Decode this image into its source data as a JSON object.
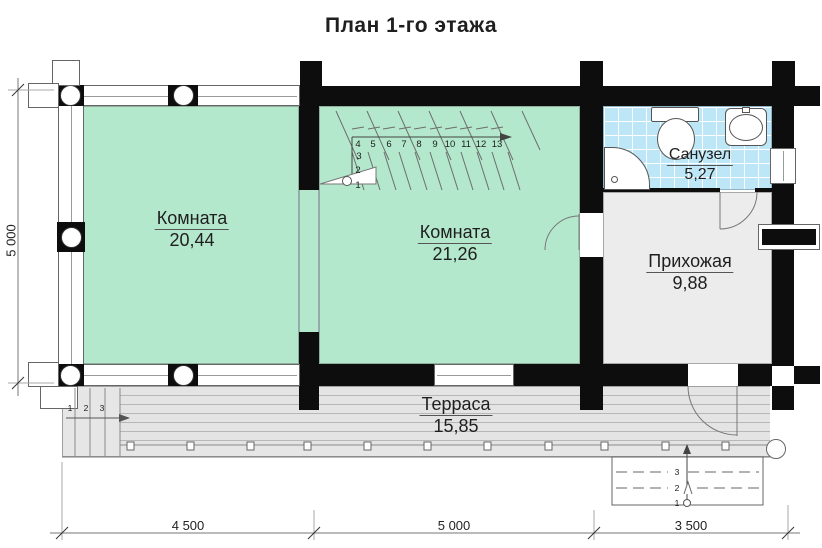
{
  "title": "План 1-го этажа",
  "rooms": {
    "room1": {
      "name": "Комната",
      "area": "20,44"
    },
    "room2": {
      "name": "Комната",
      "area": "21,26"
    },
    "bathroom": {
      "name": "Санузел",
      "area": "5,27"
    },
    "hallway": {
      "name": "Прихожая",
      "area": "9,88"
    },
    "terrace": {
      "name": "Терраса",
      "area": "15,85"
    }
  },
  "dimensions": {
    "left_height": "5 000",
    "bottom": [
      "4 500",
      "5 000",
      "3 500"
    ]
  },
  "stairs": {
    "main_treads": [
      "4",
      "5",
      "6",
      "7",
      "8",
      "9",
      "10",
      "11",
      "12",
      "13"
    ],
    "lower_treads": [
      "3",
      "2",
      "1"
    ],
    "terrace_side_steps": [
      "1",
      "2",
      "3"
    ],
    "entrance_steps": [
      "3",
      "2",
      "1"
    ]
  },
  "colors": {
    "wall": "#0d0d0d",
    "green": "#b4e8cc",
    "tile": "#bde6f6",
    "hall": "#ececec",
    "terrace": "#e6e6e6"
  }
}
